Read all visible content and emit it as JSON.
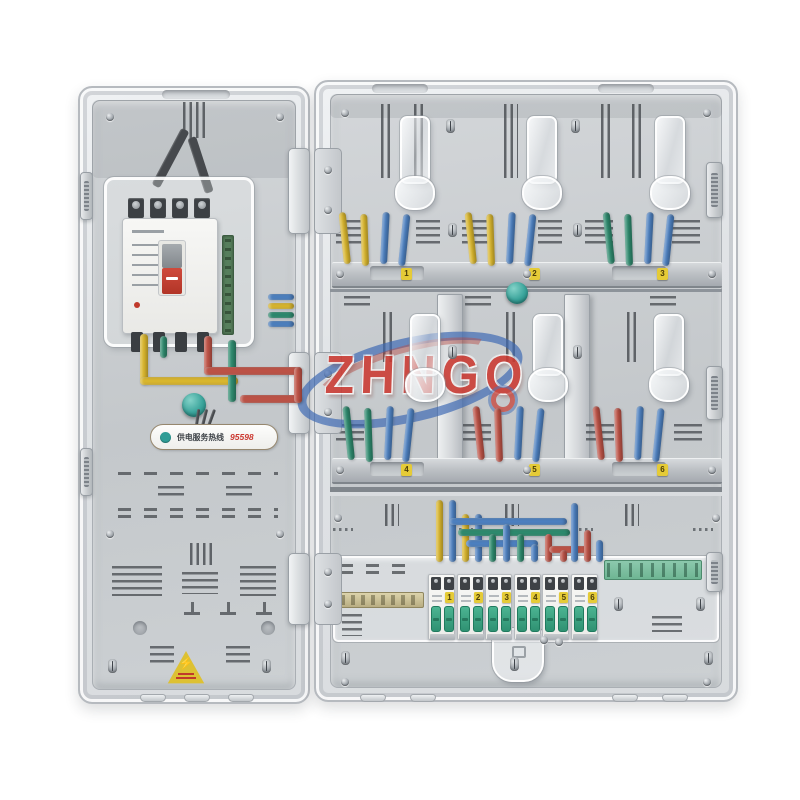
{
  "product_label": {
    "brand_watermark": "ZHNGO"
  },
  "left_panel": {
    "hotline": {
      "prefix": "供电服务热线",
      "number": "95598"
    },
    "warning_symbol": "⚡"
  },
  "meter_rows": {
    "top": {
      "bays": [
        {
          "label": "1",
          "wires": [
            "yellow",
            "yellow",
            "blue",
            "blue"
          ]
        },
        {
          "label": "2",
          "wires": [
            "yellow",
            "yellow",
            "blue",
            "blue"
          ]
        },
        {
          "label": "3",
          "wires": [
            "green",
            "green",
            "blue",
            "blue"
          ]
        }
      ]
    },
    "middle": {
      "bays": [
        {
          "label": "4",
          "wires": [
            "green",
            "green",
            "blue",
            "blue"
          ]
        },
        {
          "label": "5",
          "wires": [
            "red",
            "red",
            "blue",
            "blue"
          ]
        },
        {
          "label": "6",
          "wires": [
            "red",
            "red",
            "blue",
            "blue"
          ]
        }
      ]
    }
  },
  "distribution_row": {
    "breakers": [
      {
        "number": "1"
      },
      {
        "number": "2"
      },
      {
        "number": "3"
      },
      {
        "number": "4"
      },
      {
        "number": "5"
      },
      {
        "number": "6"
      }
    ]
  },
  "palette": {
    "yellow": "#d9b62e",
    "blue": "#4d80c0",
    "green": "#2e8a6e",
    "red": "#bd5347",
    "teal_button": "#3aa8a0",
    "toggle_green": "#34a182",
    "sticker_yellow": "#e5cb37",
    "logo_red": "#cc3a32",
    "logo_blue": "#3d69b4"
  },
  "left_wiring": [
    {
      "x": 140,
      "y": 334,
      "w": 8,
      "h": 50,
      "c": "yellow"
    },
    {
      "x": 140,
      "y": 377,
      "w": 98,
      "h": 8,
      "c": "yellow"
    },
    {
      "x": 228,
      "y": 340,
      "w": 8,
      "h": 62,
      "c": "green"
    },
    {
      "x": 160,
      "y": 336,
      "w": 7,
      "h": 22,
      "c": "green"
    },
    {
      "x": 204,
      "y": 336,
      "w": 8,
      "h": 38,
      "c": "red"
    },
    {
      "x": 204,
      "y": 367,
      "w": 98,
      "h": 8,
      "c": "red"
    },
    {
      "x": 240,
      "y": 395,
      "w": 62,
      "h": 8,
      "c": "red"
    },
    {
      "x": 294,
      "y": 367,
      "w": 8,
      "h": 36,
      "c": "red"
    },
    {
      "x": 268,
      "y": 294,
      "w": 26,
      "h": 6,
      "c": "blue"
    },
    {
      "x": 268,
      "y": 303,
      "w": 26,
      "h": 6,
      "c": "yellow"
    },
    {
      "x": 268,
      "y": 312,
      "w": 26,
      "h": 6,
      "c": "green"
    },
    {
      "x": 268,
      "y": 321,
      "w": 26,
      "h": 6,
      "c": "blue"
    }
  ],
  "bottom_wiring": [
    {
      "x": 436,
      "y": 500,
      "w": 7,
      "h": 62,
      "c": "yellow"
    },
    {
      "x": 449,
      "y": 500,
      "w": 7,
      "h": 62,
      "c": "blue"
    },
    {
      "x": 462,
      "y": 514,
      "w": 7,
      "h": 48,
      "c": "yellow"
    },
    {
      "x": 475,
      "y": 514,
      "w": 7,
      "h": 48,
      "c": "blue"
    },
    {
      "x": 449,
      "y": 518,
      "w": 118,
      "h": 7,
      "c": "blue"
    },
    {
      "x": 458,
      "y": 529,
      "w": 112,
      "h": 7,
      "c": "green"
    },
    {
      "x": 466,
      "y": 540,
      "w": 72,
      "h": 7,
      "c": "blue"
    },
    {
      "x": 489,
      "y": 534,
      "w": 7,
      "h": 28,
      "c": "green"
    },
    {
      "x": 503,
      "y": 524,
      "w": 7,
      "h": 38,
      "c": "blue"
    },
    {
      "x": 517,
      "y": 534,
      "w": 7,
      "h": 28,
      "c": "green"
    },
    {
      "x": 531,
      "y": 544,
      "w": 7,
      "h": 18,
      "c": "blue"
    },
    {
      "x": 545,
      "y": 534,
      "w": 7,
      "h": 28,
      "c": "red"
    },
    {
      "x": 549,
      "y": 546,
      "w": 40,
      "h": 7,
      "c": "red"
    },
    {
      "x": 560,
      "y": 550,
      "w": 7,
      "h": 12,
      "c": "red"
    },
    {
      "x": 571,
      "y": 503,
      "w": 7,
      "h": 59,
      "c": "blue"
    },
    {
      "x": 584,
      "y": 530,
      "w": 7,
      "h": 32,
      "c": "red"
    },
    {
      "x": 596,
      "y": 540,
      "w": 7,
      "h": 22,
      "c": "blue"
    }
  ],
  "screws": {
    "round": [
      [
        110,
        117
      ],
      [
        280,
        117
      ],
      [
        110,
        534
      ],
      [
        280,
        534
      ],
      [
        345,
        113
      ],
      [
        707,
        113
      ],
      [
        340,
        274
      ],
      [
        527,
        274
      ],
      [
        712,
        274
      ],
      [
        340,
        470
      ],
      [
        527,
        470
      ],
      [
        712,
        470
      ],
      [
        338,
        518
      ],
      [
        716,
        518
      ],
      [
        544,
        640
      ],
      [
        559,
        642
      ],
      [
        345,
        682
      ],
      [
        707,
        682
      ]
    ],
    "oval": [
      [
        112,
        666
      ],
      [
        266,
        666
      ],
      [
        450,
        126
      ],
      [
        575,
        126
      ],
      [
        452,
        230
      ],
      [
        577,
        230
      ],
      [
        452,
        352
      ],
      [
        577,
        352
      ],
      [
        345,
        658
      ],
      [
        708,
        658
      ],
      [
        514,
        664
      ],
      [
        618,
        604
      ],
      [
        700,
        604
      ]
    ]
  }
}
